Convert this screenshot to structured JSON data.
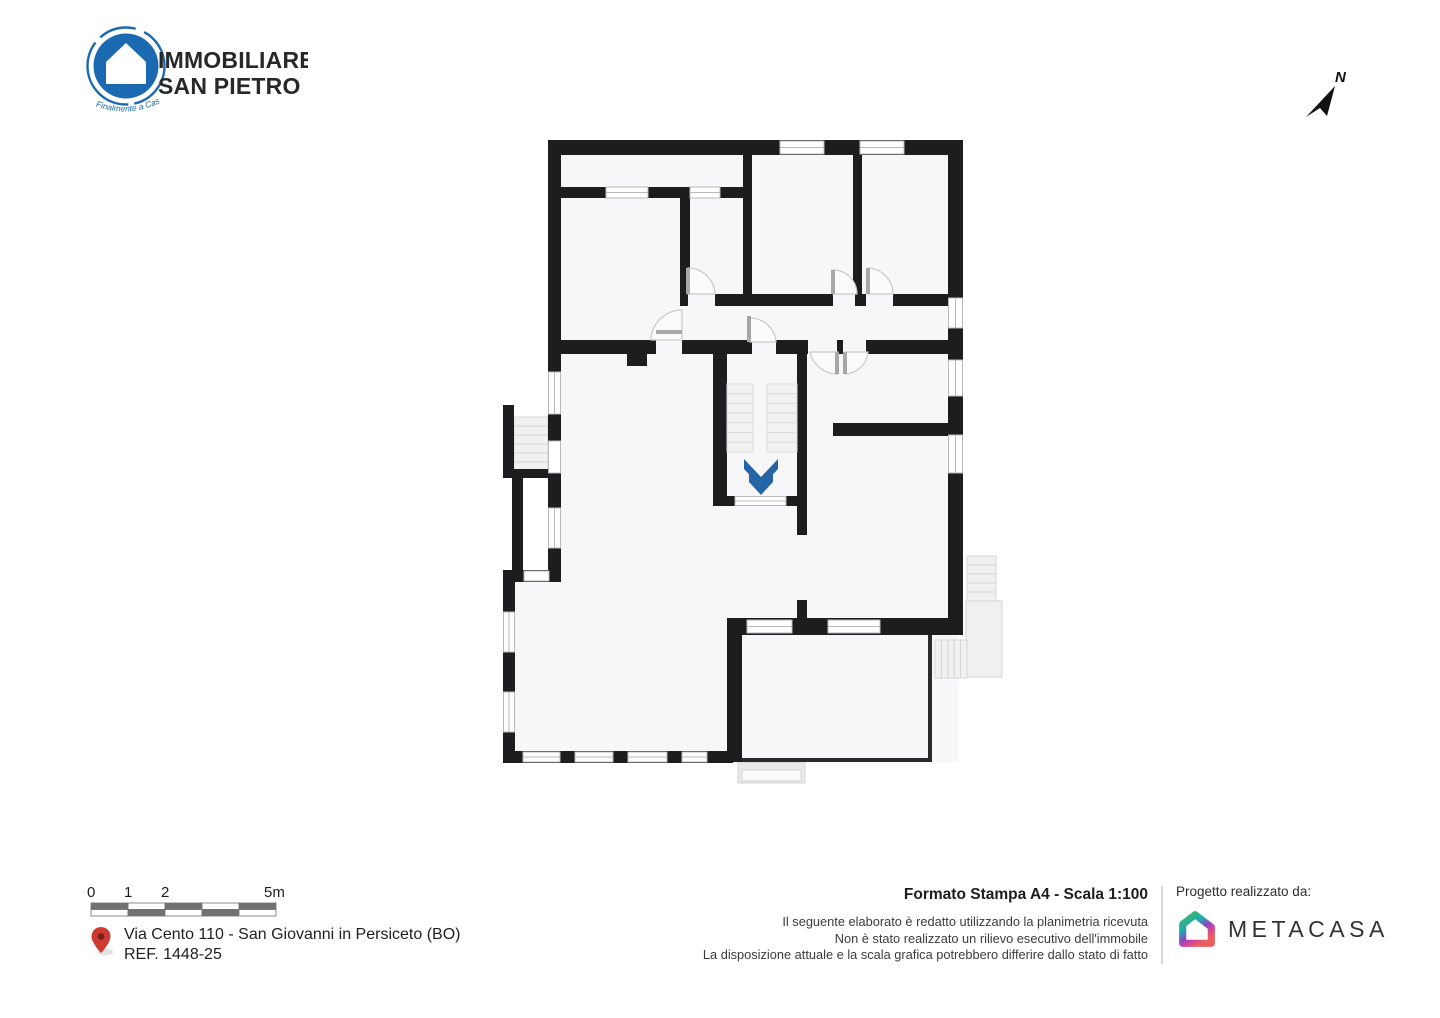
{
  "branding": {
    "logo_line1": "IMMOBILIARE",
    "logo_line2": "SAN PIETRO",
    "logo_tagline": "Finalmente a Casa",
    "logo_blue": "#1b6ab1"
  },
  "compass": {
    "label": "N"
  },
  "floor_plan": {
    "wall_color": "#1d1d1f",
    "room_fill": "#f7f7f9",
    "stair_arrow_color": "#2565a6",
    "stair_arrow_meaning": "stairs-down-direction"
  },
  "scale_bar": {
    "labels": [
      "0",
      "1",
      "2",
      "5m"
    ]
  },
  "location": {
    "address": "Via Cento 110 - San Giovanni in Persiceto (BO)",
    "reference": "REF. 1448-25",
    "pin_color": "#cf3a32"
  },
  "print_info": {
    "title": "Formato Stampa A4 - Scala 1:100",
    "disclaimer": [
      "Il seguente elaborato è redatto utilizzando la planimetria ricevuta",
      "Non è stato realizzato un rilievo esecutivo dell'immobile",
      "La disposizione attuale e la scala grafica potrebbero differire dallo stato di fatto"
    ]
  },
  "credits": {
    "label": "Progetto realizzato da:",
    "brand": "METACASA"
  }
}
